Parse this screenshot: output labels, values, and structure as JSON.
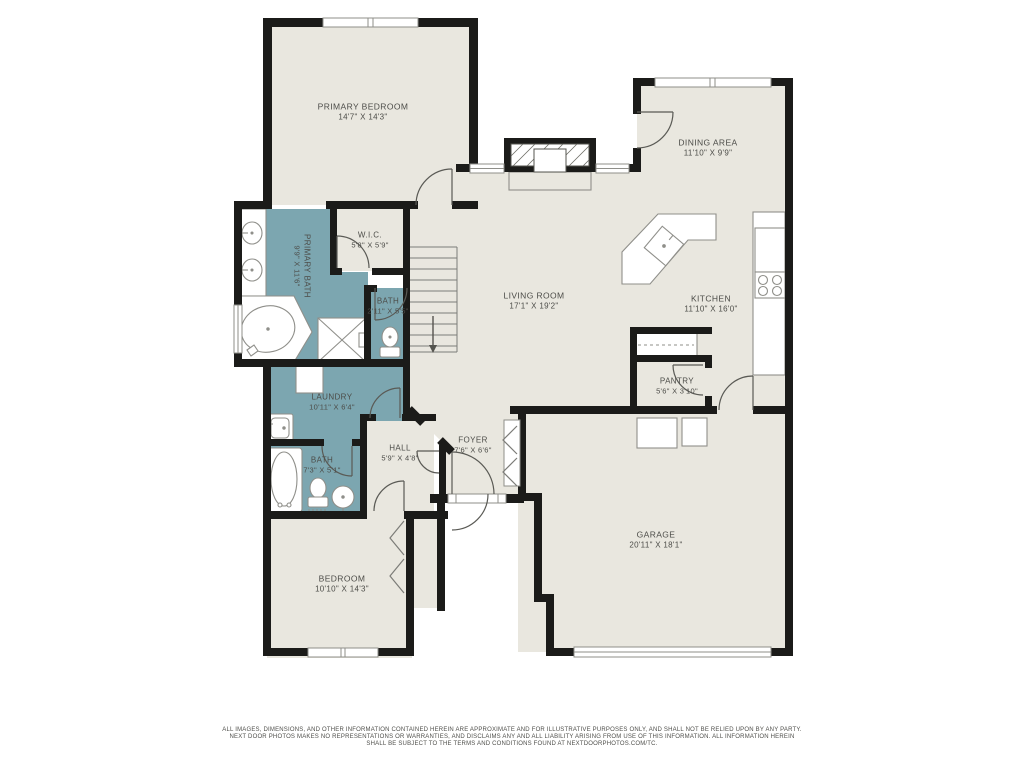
{
  "rooms": [
    {
      "id": "primary-bedroom",
      "name": "PRIMARY BEDROOM",
      "dims": "14'7\" X 14'3\""
    },
    {
      "id": "dining-area",
      "name": "DINING AREA",
      "dims": "11'10\" X 9'9\""
    },
    {
      "id": "wic",
      "name": "W.I.C.",
      "dims": "5'8\" X 5'9\""
    },
    {
      "id": "primary-bath",
      "name": "PRIMARY BATH",
      "dims": "9'9\" X 11'6\""
    },
    {
      "id": "bath-small",
      "name": "BATH",
      "dims": "2'11\" X 5'5\""
    },
    {
      "id": "living-room",
      "name": "LIVING ROOM",
      "dims": "17'1\" X 19'2\""
    },
    {
      "id": "kitchen",
      "name": "KITCHEN",
      "dims": "11'10\" X 16'0\""
    },
    {
      "id": "pantry",
      "name": "PANTRY",
      "dims": "5'6\" X 3'10\""
    },
    {
      "id": "laundry",
      "name": "LAUNDRY",
      "dims": "10'11\" X 6'4\""
    },
    {
      "id": "hall",
      "name": "HALL",
      "dims": "5'9\" X 4'8\""
    },
    {
      "id": "foyer",
      "name": "FOYER",
      "dims": "7'6\" X 6'6\""
    },
    {
      "id": "bath",
      "name": "BATH",
      "dims": "7'3\" X 5'1\""
    },
    {
      "id": "bedroom",
      "name": "BEDROOM",
      "dims": "10'10\" X 14'3\""
    },
    {
      "id": "garage",
      "name": "GARAGE",
      "dims": "20'11\" X 18'1\""
    }
  ],
  "disclaimer": {
    "line1": "ALL IMAGES, DIMENSIONS, AND OTHER INFORMATION CONTAINED HEREIN ARE APPROXIMATE AND FOR ILLUSTRATIVE PURPOSES ONLY, AND SHALL NOT BE RELIED UPON BY ANY PARTY.",
    "line2": "NEXT DOOR PHOTOS MAKES NO REPRESENTATIONS OR WARRANTIES, AND DISCLAIMS ANY AND ALL LIABILITY ARISING FROM USE OF THIS INFORMATION. ALL INFORMATION HEREIN",
    "line3": "SHALL BE SUBJECT TO THE TERMS AND CONDITIONS FOUND AT NEXTDOORPHOTOS.COM/TC."
  },
  "colors": {
    "floor_beige": "#e9e7df",
    "accent_teal": "#7ca6b0",
    "wall_black": "#1b1b19"
  }
}
